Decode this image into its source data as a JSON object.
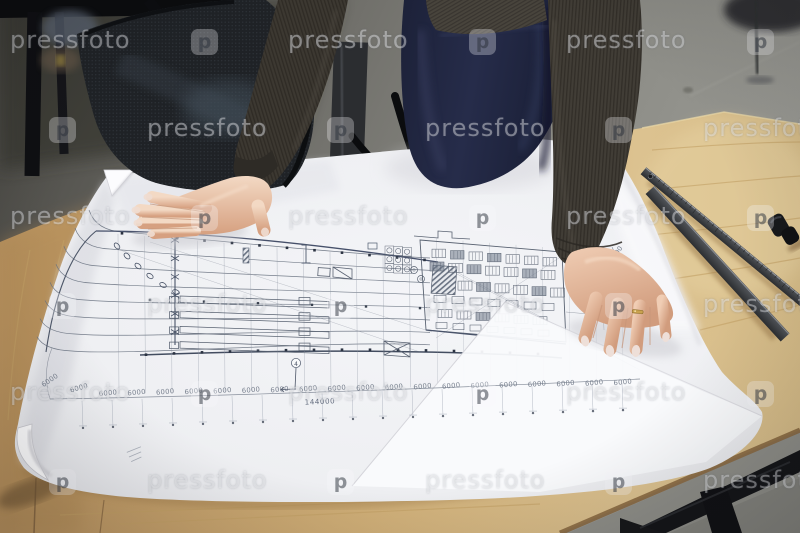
{
  "watermark": {
    "label": "pressfoto",
    "logo_letter": "p"
  },
  "blueprint": {
    "bottom_dimensions": [
      "6000",
      "6000",
      "6000",
      "6000",
      "6000",
      "6000",
      "6000",
      "6000",
      "6000",
      "6000",
      "6000",
      "6000",
      "6000",
      "6000",
      "6000",
      "6000",
      "6000",
      "6000",
      "6000",
      "6000",
      "6000"
    ],
    "right_dimensions": [
      "6000",
      "6000",
      "6000",
      "6000"
    ],
    "total_dimension": "144000",
    "axis_marker": "4"
  },
  "colors": {
    "paper": "#f0f1f4",
    "blueprint_line": "#5f6879",
    "wood": "#cfae77",
    "floor": "#8a8a84",
    "chair_mesh": "#1f2226",
    "sweater": "#3c3831",
    "apron_navy": "#232943",
    "skin": "#e6bca2",
    "steel_ruler": "#45484c",
    "watermark_tint": "rgba(250,250,252,0.4)"
  }
}
